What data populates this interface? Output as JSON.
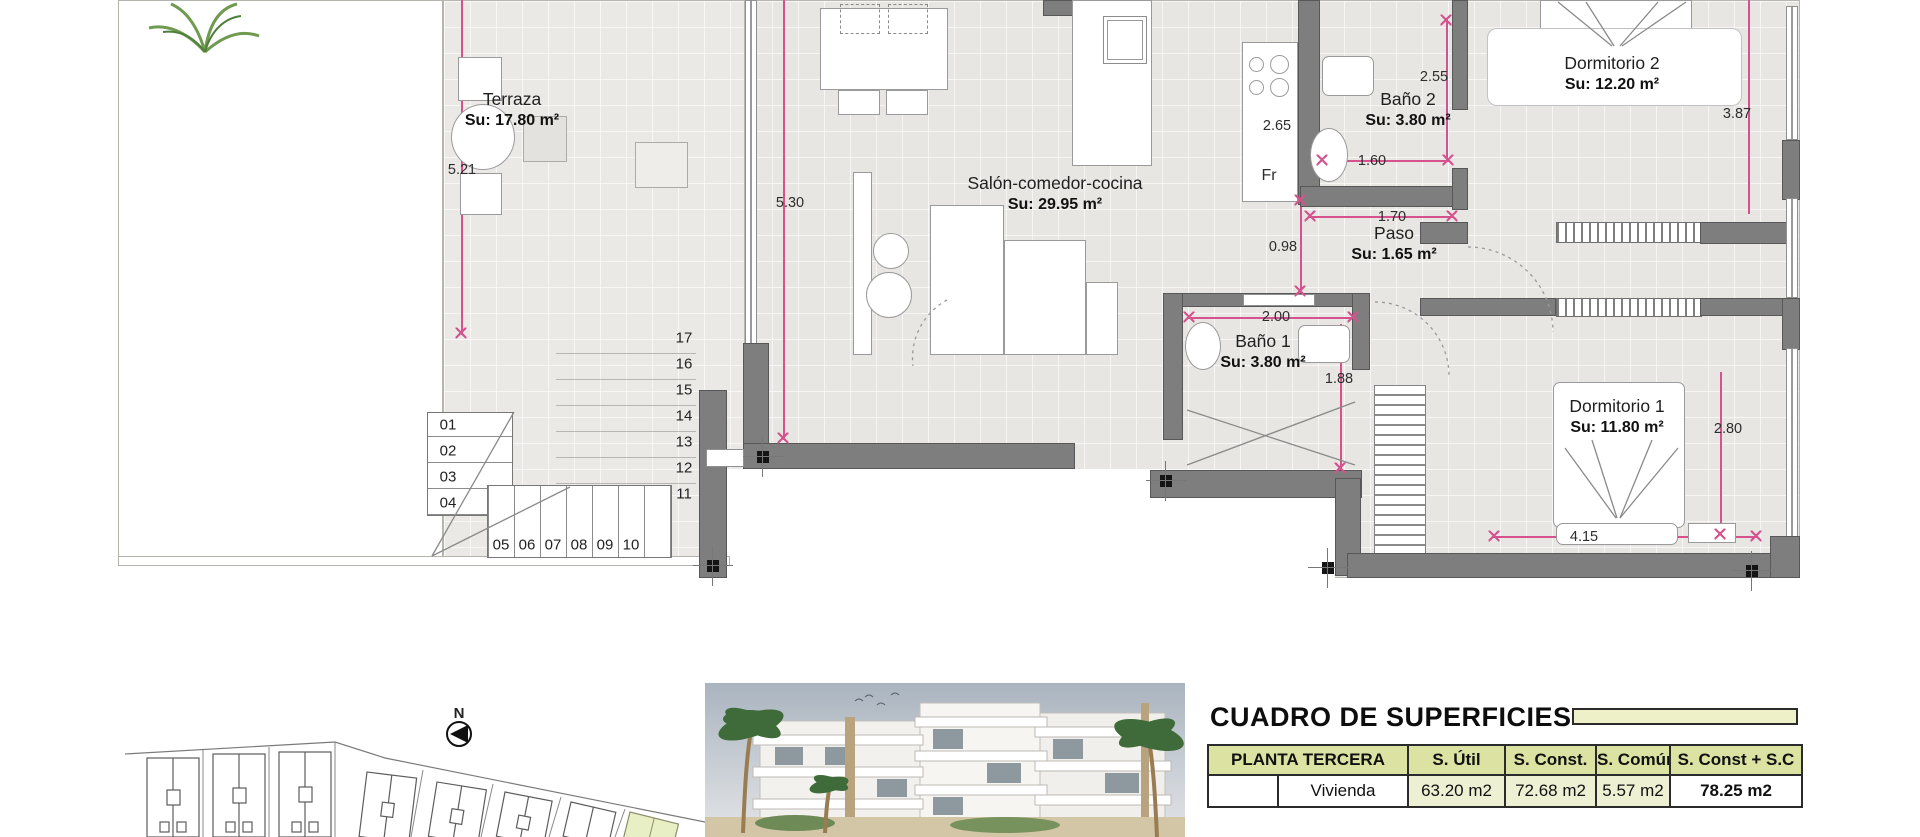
{
  "plan": {
    "rooms": [
      {
        "id": "terraza",
        "name": "Terraza",
        "area": "Su: 17.80 m²",
        "x": 512,
        "y": 88
      },
      {
        "id": "salon",
        "name": "Salón-comedor-cocina",
        "area": "Su: 29.95 m²",
        "x": 1055,
        "y": 172
      },
      {
        "id": "bano2",
        "name": "Baño 2",
        "area": "Su: 3.80 m²",
        "x": 1408,
        "y": 88
      },
      {
        "id": "dormitorio2",
        "name": "Dormitorio 2",
        "area": "Su: 12.20 m²",
        "x": 1612,
        "y": 52
      },
      {
        "id": "paso",
        "name": "Paso",
        "area": "Su: 1.65 m²",
        "x": 1394,
        "y": 222
      },
      {
        "id": "bano1",
        "name": "Baño 1",
        "area": "Su: 3.80 m²",
        "x": 1263,
        "y": 330
      },
      {
        "id": "dormitorio1",
        "name": "Dormitorio 1",
        "area": "Su: 11.80 m²",
        "x": 1617,
        "y": 395
      }
    ],
    "dimensions": [
      {
        "text": "5.21",
        "x": 462,
        "y": 170
      },
      {
        "text": "5.30",
        "x": 790,
        "y": 203
      },
      {
        "text": "2.65",
        "x": 1277,
        "y": 126
      },
      {
        "text": "0.98",
        "x": 1283,
        "y": 247
      },
      {
        "text": "2.55",
        "x": 1434,
        "y": 77
      },
      {
        "text": "1.60",
        "x": 1372,
        "y": 161
      },
      {
        "text": "1.70",
        "x": 1392,
        "y": 217
      },
      {
        "text": "2.00",
        "x": 1276,
        "y": 317
      },
      {
        "text": "1.88",
        "x": 1339,
        "y": 379
      },
      {
        "text": "3.87",
        "x": 1737,
        "y": 114
      },
      {
        "text": "2.80",
        "x": 1728,
        "y": 429
      },
      {
        "text": "4.15",
        "x": 1584,
        "y": 537
      }
    ],
    "fridge_label": "Fr",
    "stairs": {
      "left_numbers": [
        "01",
        "02",
        "03",
        "04"
      ],
      "bottom_numbers": [
        "05",
        "06",
        "07",
        "08",
        "09",
        "10"
      ],
      "right_numbers": [
        "17",
        "16",
        "15",
        "14",
        "13",
        "12",
        "11"
      ]
    }
  },
  "site_plan": {
    "compass_label": "N"
  },
  "table": {
    "title": "CUADRO DE SUPERFICIES",
    "col_headers": [
      "PLANTA TERCERA",
      "S. Útil",
      "S. Const.",
      "S. Común",
      "S. Const + S.C"
    ],
    "rows": [
      {
        "label": "Vivienda",
        "s_util": "63.20 m2",
        "s_const": "72.68 m2",
        "s_comun": "5.57 m2",
        "s_const_sc": "78.25 m2"
      }
    ]
  },
  "colors": {
    "dimension_pink": "#d6528f",
    "wall_gray": "#7e7e7e",
    "table_header_bg": "#dce3a2",
    "accent_bar_bg": "#eef0c8",
    "highlight_building": "#e9efc5"
  }
}
